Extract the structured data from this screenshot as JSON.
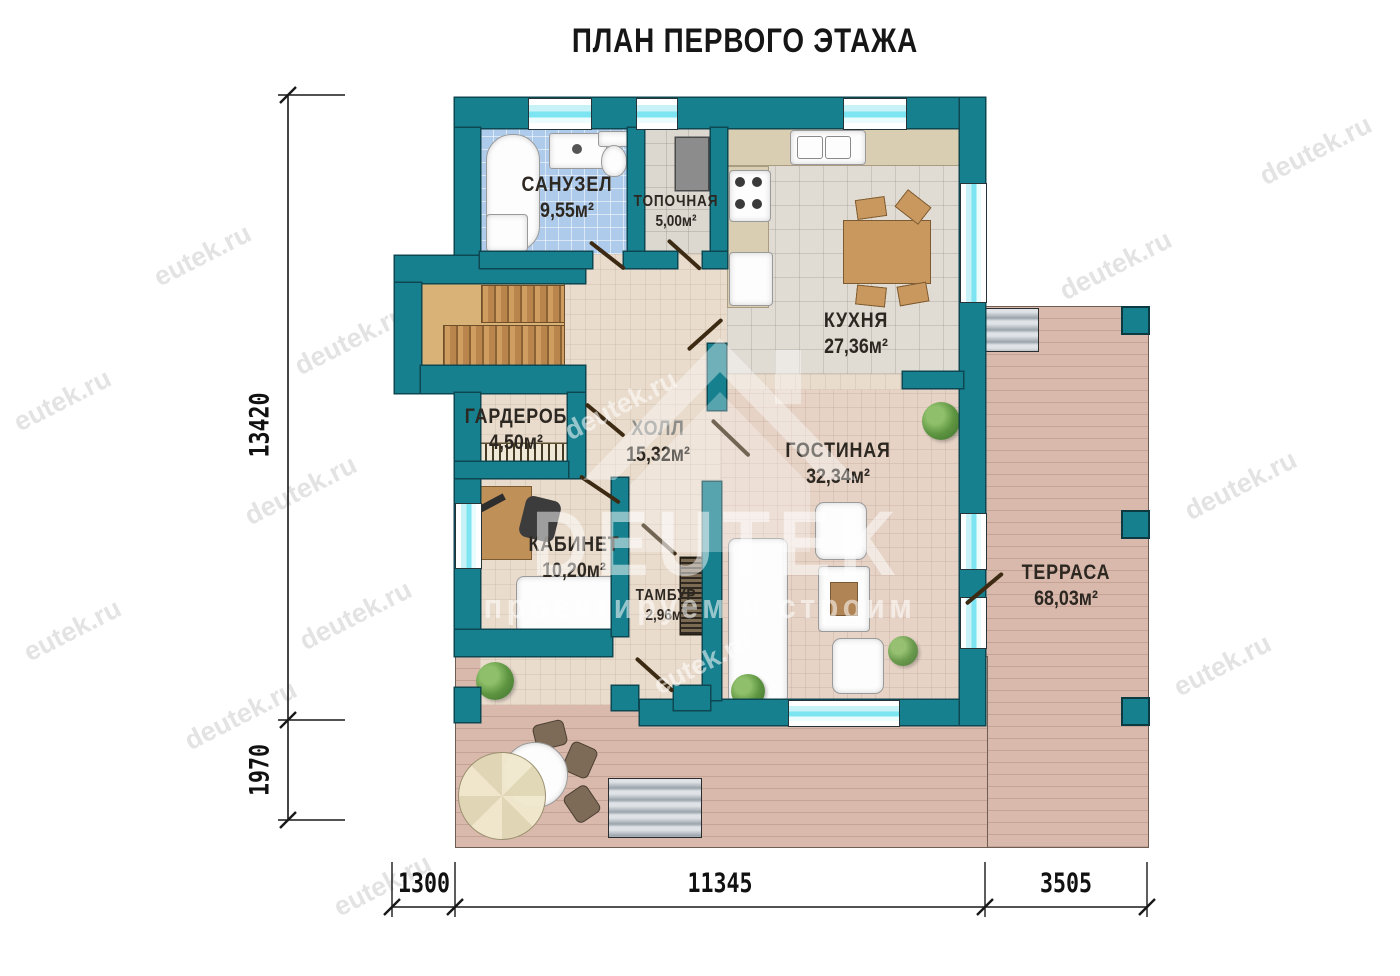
{
  "title": "ПЛАН ПЕРВОГО ЭТАЖА",
  "rooms": {
    "sanuzel": {
      "name": "САНУЗЕЛ",
      "area": "9,55м²"
    },
    "topochnaya": {
      "name": "ТОПОЧНАЯ",
      "area": "5,00м²"
    },
    "kuhnya": {
      "name": "КУХНЯ",
      "area": "27,36м²"
    },
    "garderob": {
      "name": "ГАРДЕРОБ",
      "area": "4,50м²"
    },
    "holl": {
      "name": "ХОЛЛ",
      "area": "15,32м²"
    },
    "gostinaya": {
      "name": "ГОСТИНАЯ",
      "area": "32,34м²"
    },
    "kabinet": {
      "name": "КАБИНЕТ",
      "area": "10,20м²"
    },
    "tambur": {
      "name": "ТАМБУР",
      "area": "2,96м²"
    },
    "terrasa": {
      "name": "ТЕРРАСА",
      "area": "68,03м²"
    }
  },
  "dimensions": {
    "vertical": {
      "main": "13420",
      "lower": "1970"
    },
    "horizontal": {
      "left": "1300",
      "middle": "11345",
      "right": "3505"
    }
  },
  "watermarks": {
    "eutek": "eutek.ru",
    "deutek": "deutek.ru",
    "brand": "DEUTEK",
    "slogan": "проектируем и строим"
  },
  "colors": {
    "wall": "#17808F",
    "window_glass": "#7DE4F1",
    "deck": "#D9B9AC",
    "bath_tile": "#AECBEC",
    "wood": "#C9985F"
  }
}
